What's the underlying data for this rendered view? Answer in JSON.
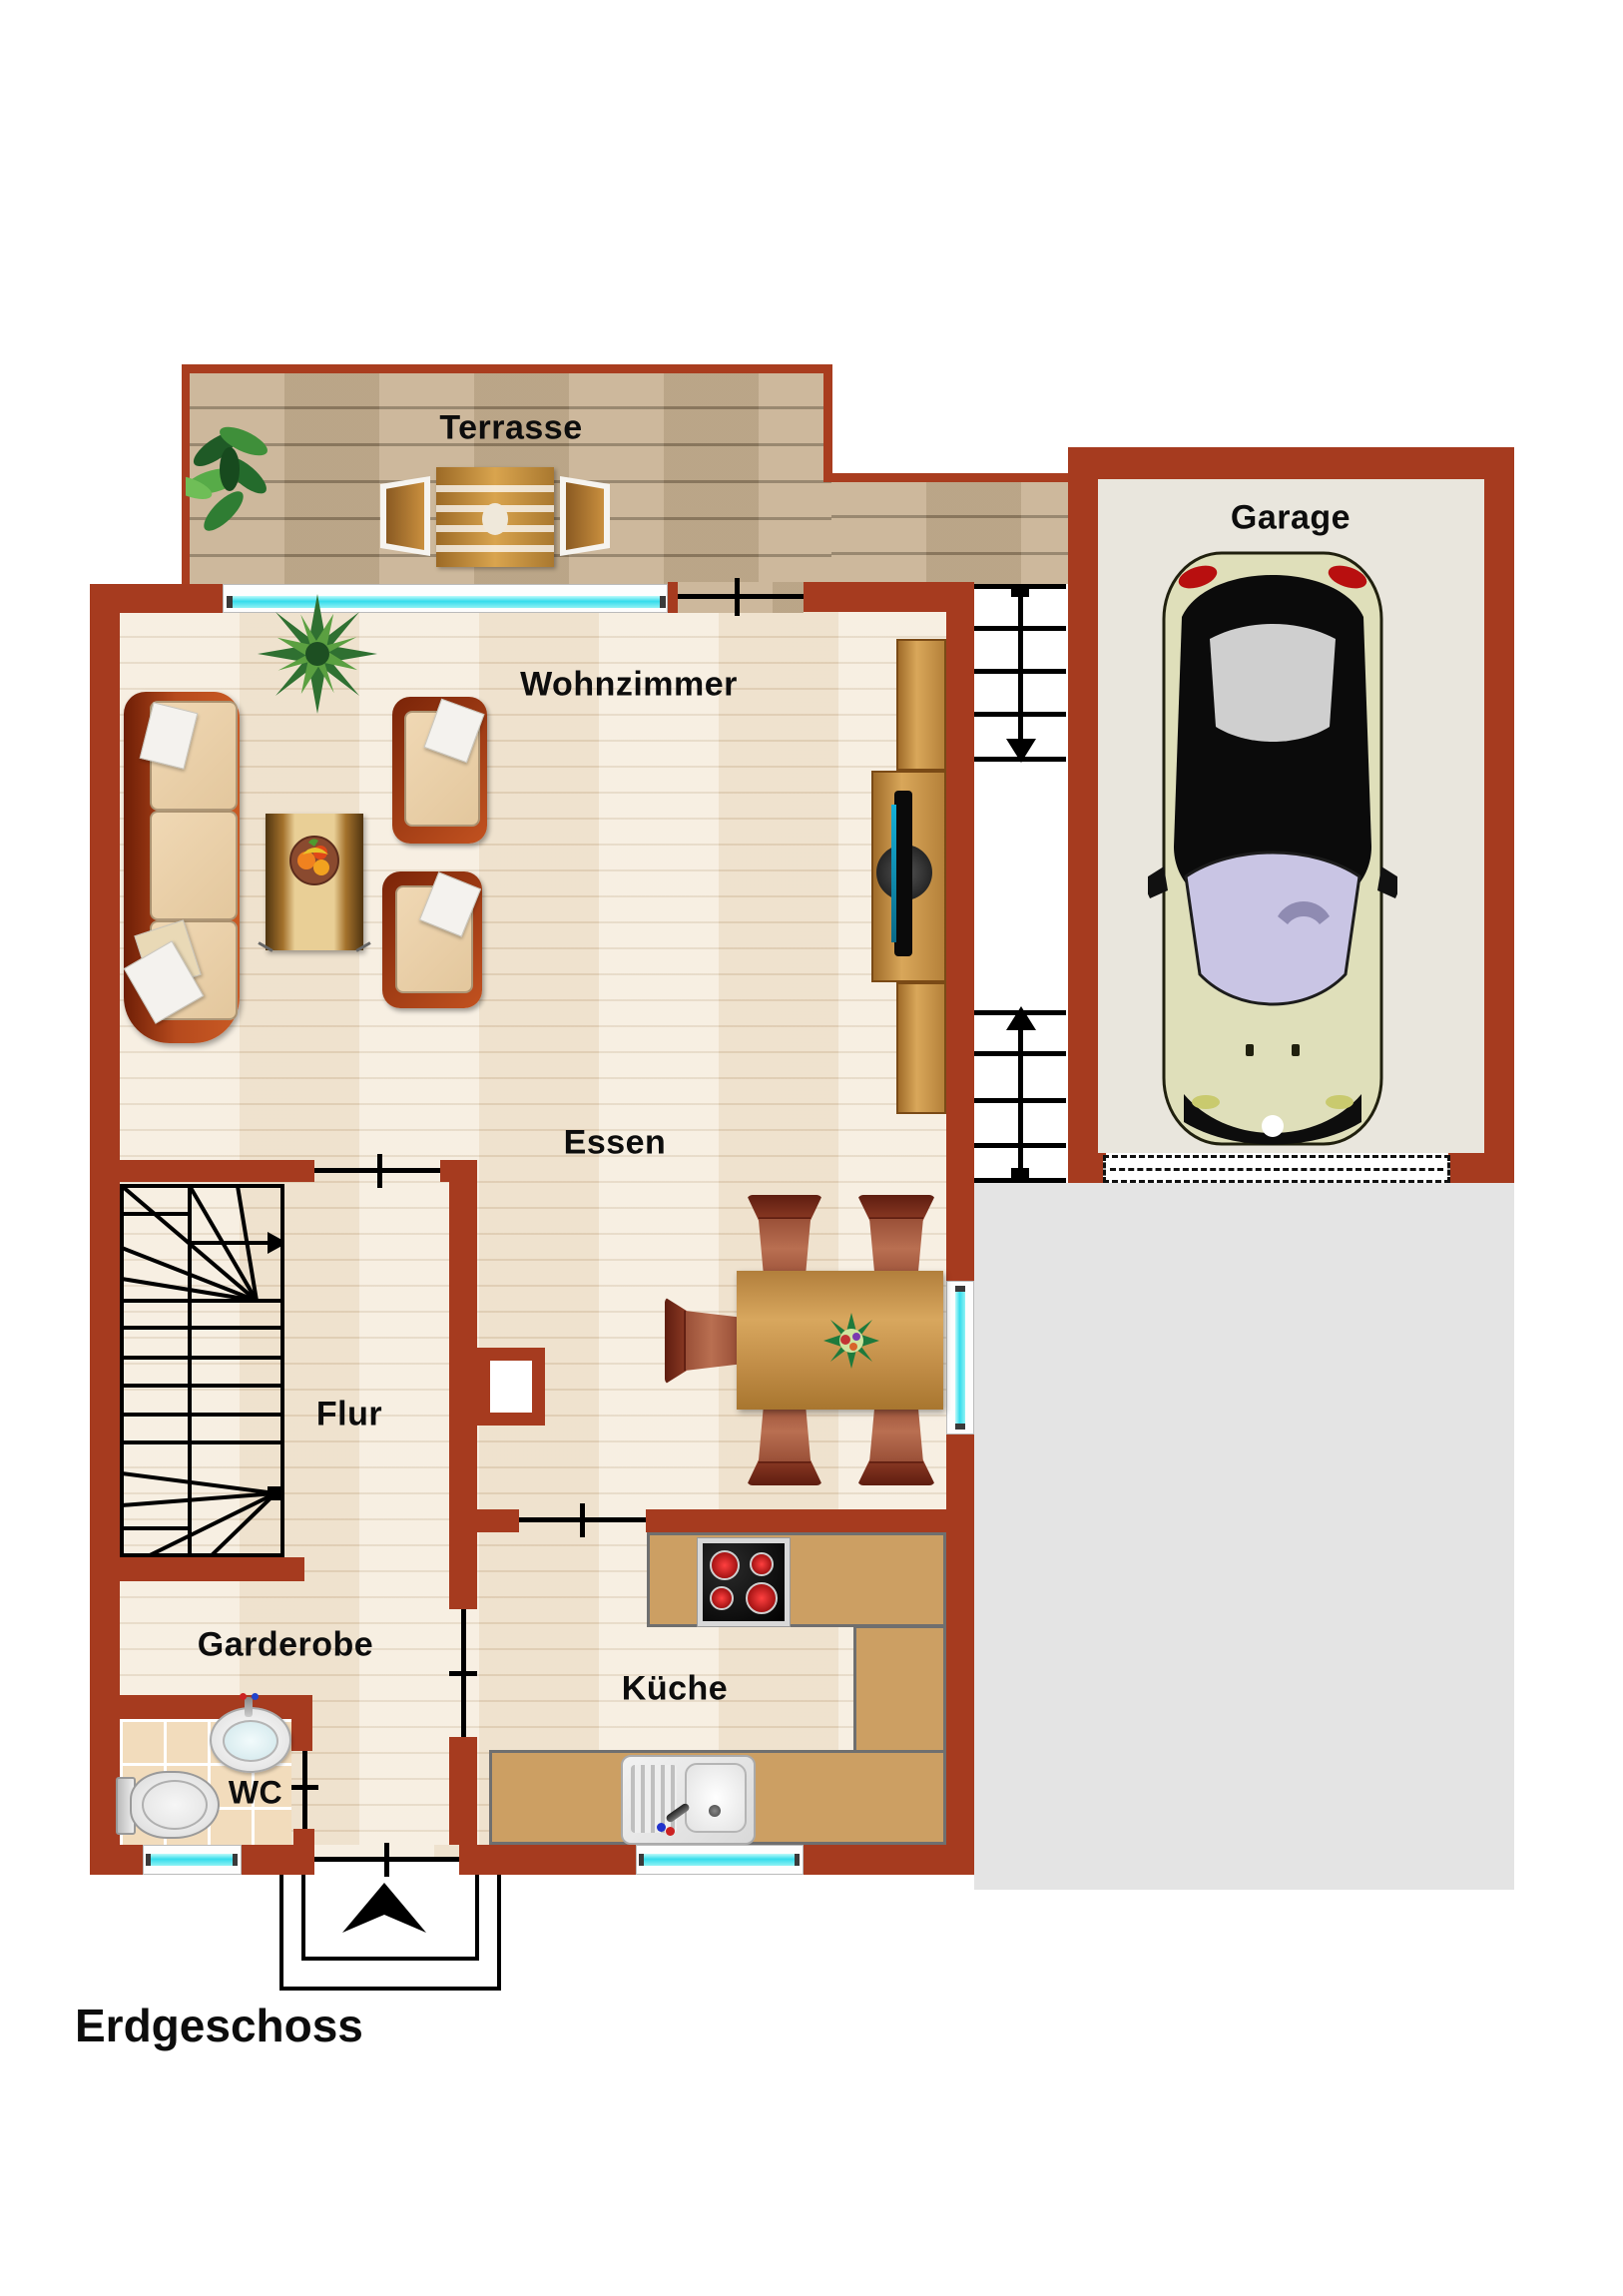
{
  "plan": {
    "title": "Erdgeschoss",
    "rooms": {
      "terrasse": "Terrasse",
      "garage": "Garage",
      "wohnzimmer": "Wohnzimmer",
      "essen": "Essen",
      "flur": "Flur",
      "garderobe": "Garderobe",
      "wc": "WC",
      "kueche": "Küche"
    },
    "colors": {
      "wall": "#a63b1f",
      "window_glass": "#35dcec",
      "deck": "#c9b394",
      "parquet": "#f4ead9",
      "driveway": "#e4e4e4",
      "garage_floor": "#e9e6dd",
      "counter": "#cc9f63"
    }
  }
}
